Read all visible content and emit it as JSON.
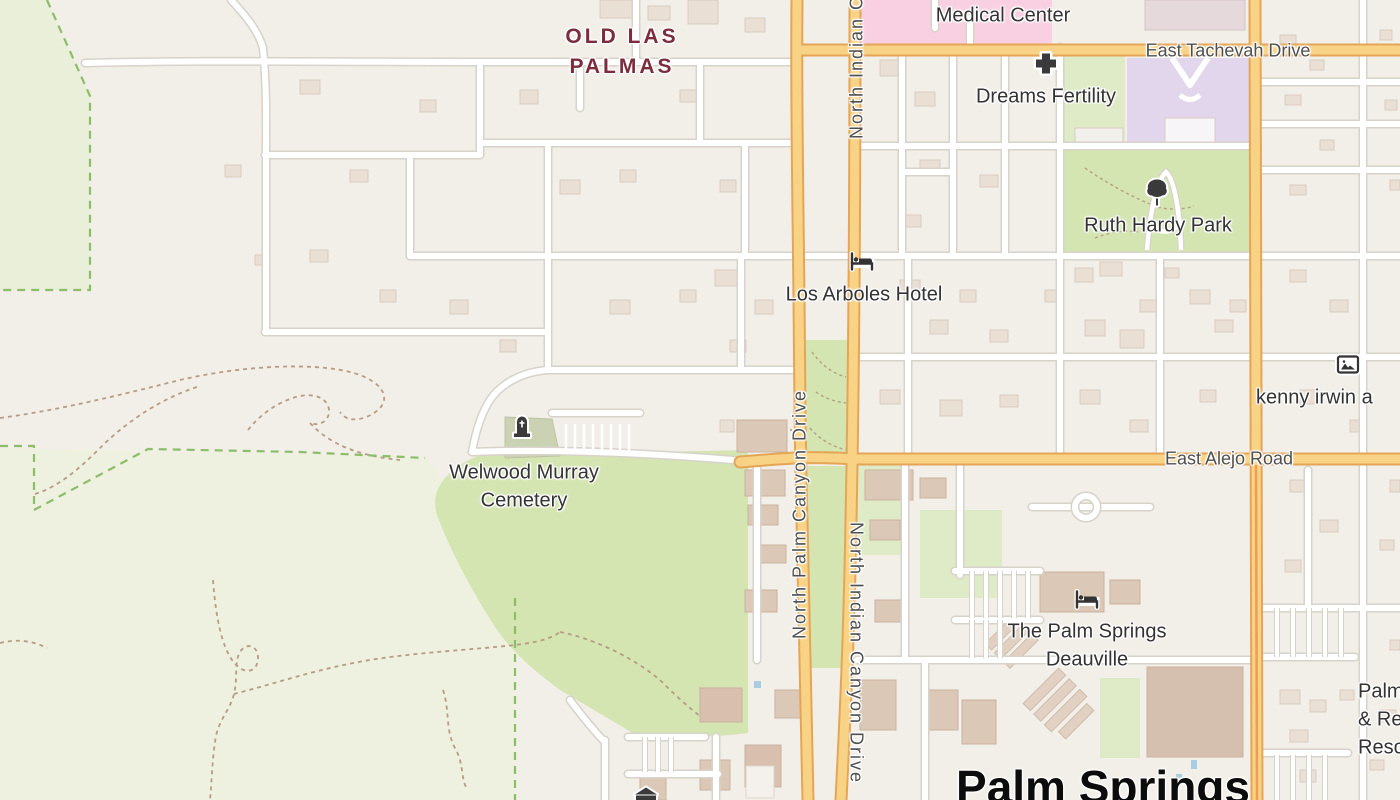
{
  "labels": {
    "neighborhood_line1": "OLD LAS",
    "neighborhood_line2": "PALMAS",
    "medical_center": "Medical Center",
    "tachevah": "East Tachevah Drive",
    "dreams_fertility": "Dreams Fertility",
    "ruth_hardy_park": "Ruth Hardy Park",
    "los_arboles_hotel": "Los Arboles Hotel",
    "kenny_irwin": "kenny irwin a",
    "alejo": "East Alejo Road",
    "welwood_line1": "Welwood Murray",
    "welwood_line2": "Cemetery",
    "palm_canyon": "North Palm Canyon Drive",
    "indian_canyon_top": "North Indian Canyon Drive",
    "indian_canyon_bottom": "North Indian Canyon Drive",
    "deauville_line1": "The Palm Springs",
    "deauville_line2": "Deauville",
    "city": "Palm Springs",
    "edge_line1": "Palm",
    "edge_line2": "& Re",
    "edge_line3": "Reso"
  },
  "icons": {
    "medical_cross": "✚",
    "tree": "🌳",
    "bed": "🛏",
    "artwork": "🖼",
    "grave": "🪦",
    "museum": "🏛"
  },
  "colors": {
    "background": "#f2efe9",
    "scrub": "#eef0e0",
    "park": "#d4e5b2",
    "grass": "#dfeac6",
    "cemetery_plot": "#cbd2b4",
    "school": "#e2d6ec",
    "hospital_pink": "#f9d0e1",
    "building": "#eadfd4",
    "building_tan": "#dcc8b6",
    "road_white": "#ffffff",
    "road_casing": "#d7d3ca",
    "arterial_fill": "#f8d385",
    "arterial_casing": "#e5a557",
    "trail": "#b69c84",
    "boundary": "#8cbd69",
    "water": "#a8cde2",
    "road_label": "#4f4f4f",
    "poi_label": "#333333",
    "neighborhood_label": "#7d2c3e",
    "city_label": "#0c0c0c"
  }
}
